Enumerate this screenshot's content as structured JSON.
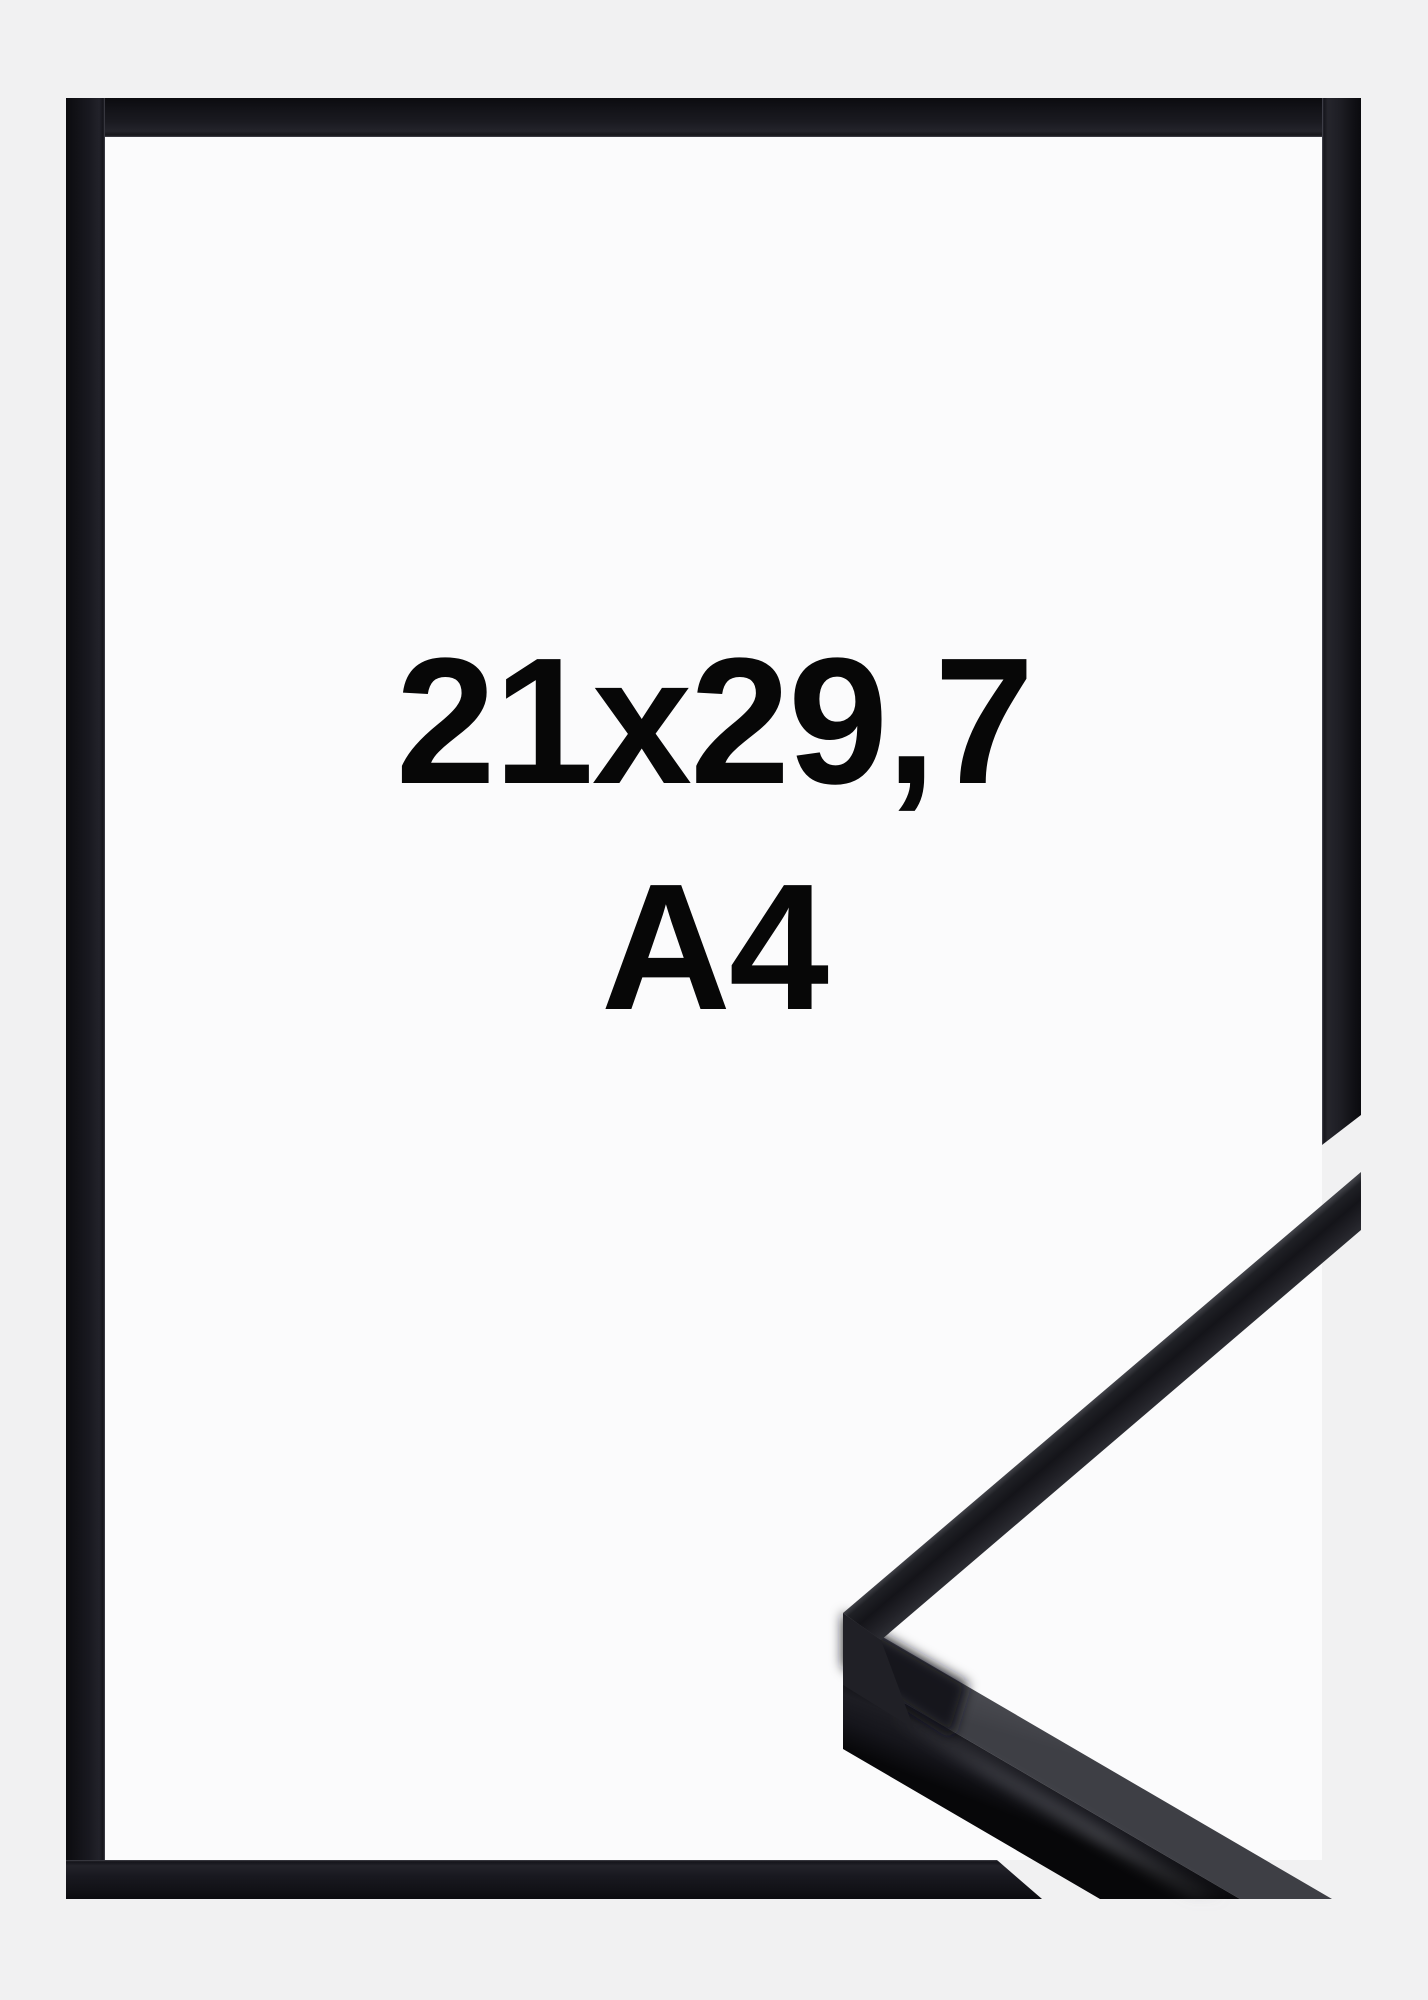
{
  "product": {
    "size_label": "21x29,7",
    "format_label": "A4"
  },
  "frame": {
    "style": "black-aluminium",
    "view": "front-with-corner-profile-detail"
  },
  "colors": {
    "background": "#f1f1f2",
    "paper_white": "#fbfbfc",
    "frame_black": "#15151a",
    "frame_inner_rim": "#3c3c44",
    "profile_side_gray": "#4a4b51",
    "profile_highlight": "#45464c",
    "text": "#070707"
  }
}
